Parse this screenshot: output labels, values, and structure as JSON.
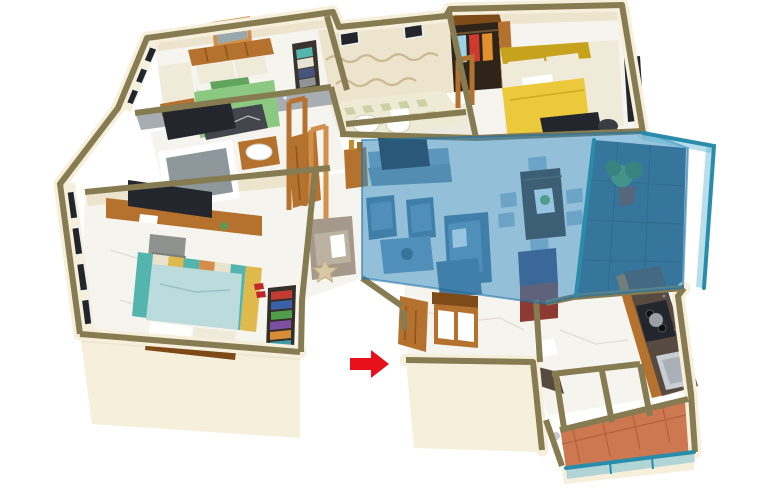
{
  "scene": {
    "type": "3d-isometric-apartment-floor-plan-render",
    "background": "white",
    "highlighted_area": "living-dining-and-balcony",
    "highlight_style": "translucent-blue-overlay",
    "entrance_indicator": {
      "shape": "arrow",
      "direction": "right",
      "color_key": "arrow"
    }
  },
  "rooms": [
    {
      "id": "bedroom-green",
      "position": "top-left",
      "items": [
        "green-double-bed",
        "wood-headboard",
        "wall-art",
        "cream-armchair",
        "dark-dresser",
        "linen-niche",
        "windowed-west-wall"
      ]
    },
    {
      "id": "common-bathroom",
      "position": "top-middle",
      "items": [
        "toilet",
        "washbasin",
        "checker-tile-floor",
        "wavy-tile-border",
        "two-small-windows",
        "towel-niche"
      ]
    },
    {
      "id": "master-bedroom-yellow",
      "position": "top-right",
      "items": [
        "yellow-double-bed",
        "open-wardrobe-with-clothes",
        "wall-tv",
        "pouf",
        "door-frame"
      ]
    },
    {
      "id": "ensuite-bathroom",
      "position": "mid-left",
      "items": [
        "bathtub",
        "washbasin",
        "mosaic-wall",
        "wood-door"
      ]
    },
    {
      "id": "study-bedroom",
      "position": "bottom-left",
      "items": [
        "wall-desk",
        "monitor",
        "desk-chair",
        "striped-rug",
        "light-blue-bed",
        "bookshelf",
        "red-slippers",
        "windowed-west-wall"
      ]
    },
    {
      "id": "lounge-nook",
      "position": "center-left",
      "items": [
        "armchair-with-pillow",
        "starfish-decor",
        "bottle-console"
      ]
    },
    {
      "id": "living-dining",
      "position": "center",
      "highlighted": true,
      "items": [
        "tv-console",
        "tv",
        "two-cube-chairs",
        "coffee-table",
        "sofa",
        "dining-table-six-chairs",
        "green-table-runner",
        "fridge"
      ]
    },
    {
      "id": "balcony",
      "position": "right",
      "highlighted": true,
      "items": [
        "glass-railing",
        "dark-tile-floor",
        "potted-plant"
      ]
    },
    {
      "id": "entrance-foyer",
      "position": "bottom-center",
      "items": [
        "open-wood-door",
        "shoe-console",
        "entrance-arrow"
      ]
    },
    {
      "id": "kitchen",
      "position": "bottom-right",
      "items": [
        "granite-l-counter",
        "gas-stove-with-pan",
        "steel-sink",
        "wood-cabinets",
        "washer-boxes"
      ]
    },
    {
      "id": "utility-balcony",
      "position": "bottom-right-edge",
      "items": [
        "terracotta-tile-floor",
        "glass-railing"
      ]
    }
  ],
  "colors": {
    "wall-face": "#f5efdc",
    "wall-face-shade": "#ece4cc",
    "wall-cap": "#867b51",
    "floor": "#f6f4ee",
    "floor-shade": "#edebdf",
    "vein": "#dcd7ca",
    "mosaic": "#a7adb3",
    "tile-green": "#ccd1a6",
    "tile-cream": "#efead4",
    "wave-tan": "#c9b38a",
    "highlight": "#2f89c4",
    "highlight-edge": "#176fa8",
    "glass": "#2a8cab",
    "glass-fill": "#60b5d1",
    "arrow": "#e8101b",
    "wood": "#b5722e",
    "wood-dark": "#7e4a18",
    "wood-light": "#d19049",
    "bed-green": "#8bc983",
    "bed-green-dark": "#61a55c",
    "throw-dark": "#43464c",
    "bed-yellow": "#ecc93b",
    "bed-yellow-dark": "#c7a31d",
    "bed-blue": "#bcdbdc",
    "bed-blue-dark": "#97c3c8",
    "pillow": "#f0ead9",
    "rug-teal": "#54b4ae",
    "rug-yellow": "#e0b94c",
    "rug-orange": "#d68d48",
    "rug-cream": "#e9e2cc",
    "tint-cabinet": "#87a2b4",
    "tint-sofa": "#4e7490",
    "tint-sofa-light": "#6e94ae",
    "chair-tint": "#a9bfcd",
    "dining-wood": "#4a3527",
    "dining-green": "#6fae4a",
    "granite": "#574a40",
    "steel": "#c9ced4",
    "terracotta": "#cd7850",
    "terracotta-line": "#a75a36",
    "balcony-tile": "#3e6274",
    "balcony-line": "#2c4a59",
    "window": "#22252a",
    "window-frame": "#eef0ee",
    "fridge-navy": "#46466e",
    "fridge-red": "#8d3a33",
    "tv-dark": "#23262d",
    "gray-chair": "#8f928e",
    "starfish": "#d8c8a4",
    "plant": "#5a9a52",
    "plant-dark": "#3f7c3c"
  }
}
